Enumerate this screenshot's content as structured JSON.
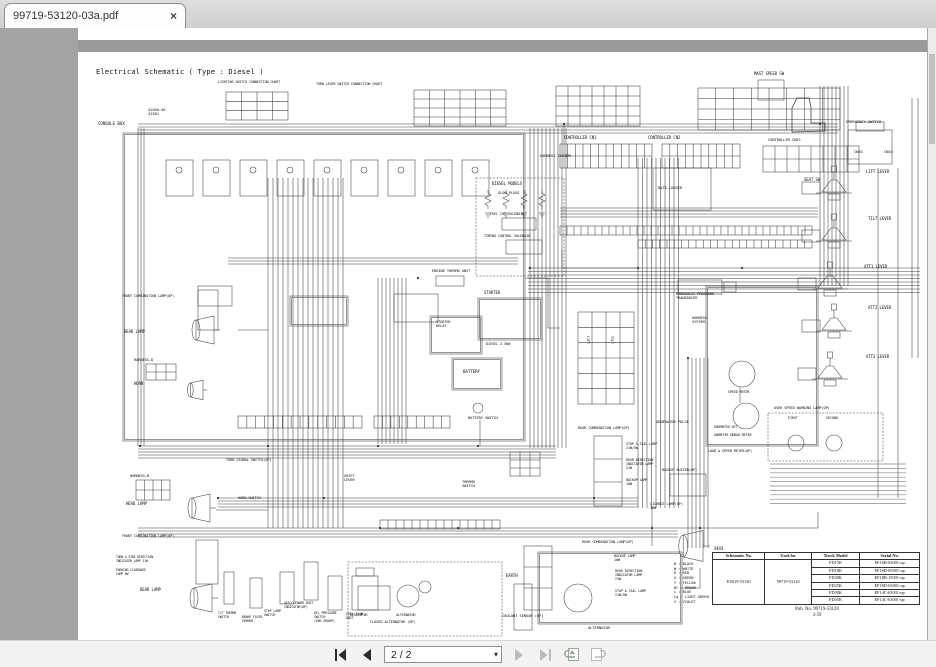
{
  "tab": {
    "title": "99719-53120-03a.pdf",
    "close_glyph": "×"
  },
  "toolbar": {
    "page_value": "2 / 2",
    "caret_glyph": "▾"
  },
  "page": {
    "title": "Electrical Schematic ( Type : Diesel )",
    "labels": [
      {
        "t": "CONSOLE BOX",
        "x": 20,
        "y": 94,
        "fs": 4.2
      },
      {
        "t": "41050-46\n41581",
        "x": 70,
        "y": 80,
        "fs": 3.8
      },
      {
        "t": "LIGHTING SWITCH CONNECTION CHART",
        "x": 140,
        "y": 52,
        "fs": 3.4
      },
      {
        "t": "TURN LEVER SWITCH CONNECTION CHART",
        "x": 238,
        "y": 54,
        "fs": 3.4
      },
      {
        "t": "CONTROLLER CN1",
        "x": 486,
        "y": 108,
        "fs": 4
      },
      {
        "t": "CONTROLLER CN2",
        "x": 570,
        "y": 108,
        "fs": 4
      },
      {
        "t": "HARNESS SYSTEM",
        "x": 462,
        "y": 126,
        "fs": 3.8
      },
      {
        "t": "DATA LOGGER",
        "x": 580,
        "y": 158,
        "fs": 3.8
      },
      {
        "t": "MAST SPEED SW",
        "x": 676,
        "y": 44,
        "fs": 4
      },
      {
        "t": "SEAT SW",
        "x": 726,
        "y": 150,
        "fs": 4
      },
      {
        "t": "EMERGENCY SWITCH",
        "x": 768,
        "y": 92,
        "fs": 3.8
      },
      {
        "t": "CONTROLLER CN51",
        "x": 690,
        "y": 110,
        "fs": 3.8
      },
      {
        "t": "CN53",
        "x": 776,
        "y": 122,
        "fs": 3.8
      },
      {
        "t": "CN54",
        "x": 806,
        "y": 122,
        "fs": 3.8
      },
      {
        "t": "LIFT LEVER",
        "x": 788,
        "y": 142,
        "fs": 4
      },
      {
        "t": "TILT LEVER",
        "x": 790,
        "y": 189,
        "fs": 4
      },
      {
        "t": "ATT1 LEVER",
        "x": 786,
        "y": 237,
        "fs": 4
      },
      {
        "t": "ATT2 LEVER",
        "x": 790,
        "y": 278,
        "fs": 4
      },
      {
        "t": "ATT3 LEVER",
        "x": 788,
        "y": 327,
        "fs": 4
      },
      {
        "t": "OVER SPEED WARNING LAMP(OP)",
        "x": 696,
        "y": 378,
        "fs": 3.6
      },
      {
        "t": "FIRST",
        "x": 710,
        "y": 388,
        "fs": 3.4
      },
      {
        "t": "SECOND",
        "x": 748,
        "y": 388,
        "fs": 3.4
      },
      {
        "t": "SPEED METER",
        "x": 650,
        "y": 362,
        "fs": 3.4
      },
      {
        "t": "LOAD METER",
        "x": 654,
        "y": 405,
        "fs": 3.4
      },
      {
        "t": "HOURMETER SET",
        "x": 636,
        "y": 398,
        "fs": 3.1
      },
      {
        "t": "ODOMETER SET",
        "x": 636,
        "y": 406,
        "fs": 3.1
      },
      {
        "t": "LOAD & SPEED METER(OP)",
        "x": 630,
        "y": 421,
        "fs": 3.5
      },
      {
        "t": "HYDRAULIC PRESSURE\nTRANSDUCER",
        "x": 598,
        "y": 264,
        "fs": 3.7
      },
      {
        "t": "HARNESS\nSYSTEM",
        "x": 614,
        "y": 288,
        "fs": 3.7
      },
      {
        "t": "GENERATOR PULSE",
        "x": 578,
        "y": 392,
        "fs": 3.8
      },
      {
        "t": "REAR COMBINATION LAMP(OP)",
        "x": 500,
        "y": 398,
        "fs": 3.6
      },
      {
        "t": "STOP & TAIL LAMP\n21W/5W",
        "x": 548,
        "y": 414,
        "fs": 3.4
      },
      {
        "t": "REAR DIRECTION\nINDICATOR LAMP\n21W",
        "x": 548,
        "y": 430,
        "fs": 3.4
      },
      {
        "t": "BACKUP LAMP\n10W",
        "x": 548,
        "y": 450,
        "fs": 3.4
      },
      {
        "t": "BACKUP BUZZER(OP)",
        "x": 584,
        "y": 440,
        "fs": 3.6
      },
      {
        "t": "LICENCE LAMP(OP)\n10W",
        "x": 572,
        "y": 474,
        "fs": 3.6
      },
      {
        "t": "REAR COMBINATION LAMP(OP)",
        "x": 504,
        "y": 512,
        "fs": 3.6
      },
      {
        "t": "BACKUP LAMP\n10W",
        "x": 536,
        "y": 526,
        "fs": 3.4
      },
      {
        "t": "REAR DIRECTION\nINDICATOR LAMP\n21W",
        "x": 537,
        "y": 541,
        "fs": 3.4
      },
      {
        "t": "STOP & TAIL LAMP\n21W/5W",
        "x": 537,
        "y": 561,
        "fs": 3.4
      },
      {
        "t": "EARTH",
        "x": 428,
        "y": 546,
        "fs": 4
      },
      {
        "t": "COOLANT SENSOR (OP)",
        "x": 424,
        "y": 586,
        "fs": 3.8
      },
      {
        "t": "ALTERNATOR",
        "x": 510,
        "y": 598,
        "fs": 3.8
      },
      {
        "t": "CLOSED ALTERNATOR (OP)",
        "x": 292,
        "y": 592,
        "fs": 3.6
      },
      {
        "t": "REGULATOR",
        "x": 272,
        "y": 585,
        "fs": 3.4
      },
      {
        "t": "ALTERNATOR",
        "x": 318,
        "y": 585,
        "fs": 3.4
      },
      {
        "t": "FUEL TANK\nUNIT",
        "x": 268,
        "y": 584,
        "fs": 3.4
      },
      {
        "t": "OIL PRESSURE\nSWITCH\n(ENG GROUP)",
        "x": 236,
        "y": 584,
        "fs": 3.3
      },
      {
        "t": "AIR CLEANER DUST\nINDICATOR(OP)",
        "x": 206,
        "y": 574,
        "fs": 3.2
      },
      {
        "t": "STOP LAMP\nSWITCH",
        "x": 186,
        "y": 582,
        "fs": 3.3
      },
      {
        "t": "BRAKE FLUID\nSENSOR",
        "x": 164,
        "y": 588,
        "fs": 3.2
      },
      {
        "t": "T/C THERMO\nSWITCH",
        "x": 140,
        "y": 584,
        "fs": 3.2
      },
      {
        "t": "FRONT COMBINATION LAMP(OP)",
        "x": 44,
        "y": 266,
        "fs": 3.5
      },
      {
        "t": "HEAD LAMP",
        "x": 46,
        "y": 302,
        "fs": 4
      },
      {
        "t": "HARNESS,D",
        "x": 56,
        "y": 330,
        "fs": 3.7
      },
      {
        "t": "HORN",
        "x": 56,
        "y": 354,
        "fs": 4
      },
      {
        "t": "HARNESS,B",
        "x": 52,
        "y": 446,
        "fs": 3.7
      },
      {
        "t": "HEAD LAMP",
        "x": 48,
        "y": 474,
        "fs": 4
      },
      {
        "t": "FRONT COMBINATION LAMP(OP)",
        "x": 44,
        "y": 506,
        "fs": 3.5
      },
      {
        "t": "TURN & SIDE DIRECTION\nINDICATOR LAMP 21W",
        "x": 38,
        "y": 528,
        "fs": 3.1
      },
      {
        "t": "PARKING CLEARANCE\nLAMP 8W",
        "x": 38,
        "y": 541,
        "fs": 3.1
      },
      {
        "t": "REAR LAMP",
        "x": 62,
        "y": 560,
        "fs": 4
      },
      {
        "t": "TURN SIGNAL SWITCH(OP)",
        "x": 148,
        "y": 430,
        "fs": 3.6
      },
      {
        "t": "HORN SWITCH",
        "x": 160,
        "y": 468,
        "fs": 3.6
      },
      {
        "t": "SHIFT\nLEVER",
        "x": 266,
        "y": 446,
        "fs": 3.7
      },
      {
        "t": "THERMO\nSWITCH",
        "x": 384,
        "y": 452,
        "fs": 3.7
      },
      {
        "t": "DIESEL MODELS",
        "x": 414,
        "y": 154,
        "fs": 4
      },
      {
        "t": "GLOW PLUGS",
        "x": 420,
        "y": 163,
        "fs": 3.7
      },
      {
        "t": "FUEL CUT SOLENOID",
        "x": 412,
        "y": 184,
        "fs": 3.5
      },
      {
        "t": "TIMING CONTROL SOLENOID",
        "x": 406,
        "y": 206,
        "fs": 3.5
      },
      {
        "t": "ENGINE THERMO UNIT",
        "x": 354,
        "y": 241,
        "fs": 3.7
      },
      {
        "t": "STARTER",
        "x": 406,
        "y": 263,
        "fs": 4
      },
      {
        "t": "STARTER\nRELAY",
        "x": 358,
        "y": 292,
        "fs": 3.6
      },
      {
        "t": "DIESEL 2.5KW",
        "x": 408,
        "y": 314,
        "fs": 3.5
      },
      {
        "t": "BATTERY",
        "x": 385,
        "y": 342,
        "fs": 4.2
      },
      {
        "t": "BATTERY SWITCH",
        "x": 390,
        "y": 388,
        "fs": 3.7
      },
      {
        "t": "LIFT",
        "x": 508,
        "y": 308,
        "fs": 3.4,
        "vert": true
      },
      {
        "t": "TILT",
        "x": 532,
        "y": 308,
        "fs": 3.4,
        "vert": true
      }
    ],
    "wire_color_legend": [
      "B : BLACK",
      "W : WHITE",
      "R : RED",
      "G : GREEN",
      "Y : YELLOW",
      "Br : BROWN",
      "L : BLUE",
      "Lg : LIGHT GREEN",
      "V : VIOLET"
    ],
    "table": {
      "heading": "MHI",
      "headers": [
        "Schematic No.",
        "Used for",
        "Truck Model",
        "Serial No."
      ],
      "schematic_no": "ES019-53120",
      "used_for": "99719-53120",
      "rows": [
        [
          "FD15K",
          "EF16B-63001-up"
        ],
        [
          "FD18K",
          "EF18D-85001-up"
        ],
        [
          "FD20K",
          "EF18B-15001-up"
        ],
        [
          "FD25K",
          "EF18D-63001-up"
        ],
        [
          "FD30K",
          "EF14C-65001-up"
        ],
        [
          "FD35K",
          "EF14C-63001-up"
        ]
      ],
      "pub_no": "Pub. No. 99719-53120",
      "page_ref": "3-59"
    }
  }
}
